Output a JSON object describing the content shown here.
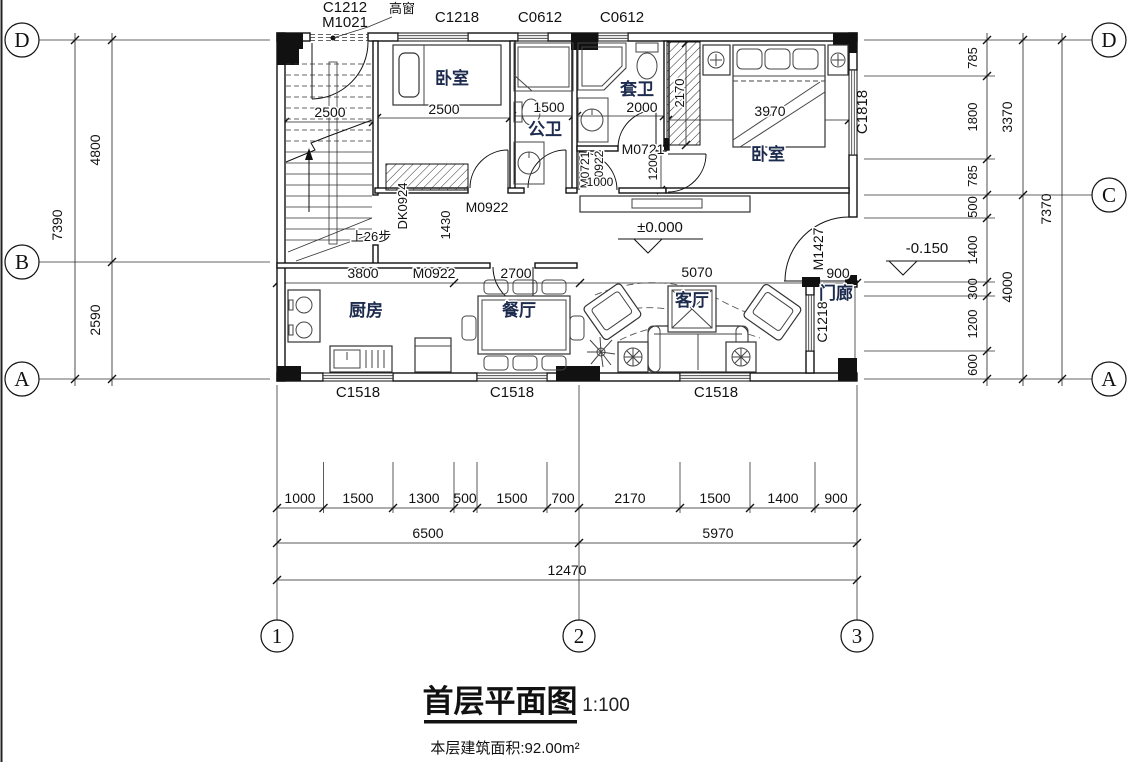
{
  "title": {
    "main": "首层平面图",
    "scale": "1:100",
    "area_note": "本层建筑面积:92.00m²"
  },
  "grid": {
    "left": [
      "D",
      "B",
      "A"
    ],
    "right": [
      "D",
      "C",
      "A"
    ],
    "bottom": [
      "1",
      "2",
      "3"
    ]
  },
  "rooms": {
    "bedroom_left": "卧室",
    "public_bath": "公卫",
    "ensuite_bath": "套卫",
    "bedroom_right": "卧室",
    "kitchen": "厨房",
    "dining": "餐厅",
    "living": "客厅",
    "porch": "门廊"
  },
  "stair": {
    "note": "上26步"
  },
  "openings": {
    "high_window_tag": "C1212",
    "entry_door_tag": "M1021",
    "high_window_note": "高窗",
    "c1218_top": "C1218",
    "c0612_left": "C0612",
    "c0612_right": "C0612",
    "c1818": "C1818",
    "m1427": "M1427",
    "c1218_porch": "C1218",
    "c1518_1": "C1518",
    "c1518_2": "C1518",
    "c1518_3": "C1518",
    "dk0924": "DK0924",
    "m0922_bedroom": "M0922",
    "m0922_kitchen": "M0922",
    "m0922_hall": "M0922",
    "m0721_bath": "M0721",
    "m0721_ensuite": "M0721"
  },
  "elevation": {
    "zero": "±0.000",
    "minus": "-0.150"
  },
  "dims": {
    "interior": {
      "stair_w": "2500",
      "bed1_w": "2500",
      "pb_w": "1500",
      "eb_w": "2000",
      "wardrobe_h": "2170",
      "hall_h": "1200",
      "hall_w": "1000",
      "corridor": "1430",
      "kitchen_w": "3800",
      "dining_w": "2700",
      "living_w": "5070",
      "porch_w": "900",
      "bed2_w": "3970"
    },
    "left": {
      "seg": [
        "4800",
        "2590"
      ],
      "total": "7390"
    },
    "right": {
      "seg": [
        "785",
        "1800",
        "785",
        "500",
        "1400",
        "300",
        "1200",
        "600"
      ],
      "mid": [
        "3370",
        "4000"
      ],
      "total": "7370"
    },
    "bottom": {
      "seg": [
        "1000",
        "1500",
        "1300",
        "500",
        "1500",
        "700",
        "2170",
        "1500",
        "1400",
        "900"
      ],
      "mid": [
        "6500",
        "5970"
      ],
      "total": "12470"
    }
  }
}
